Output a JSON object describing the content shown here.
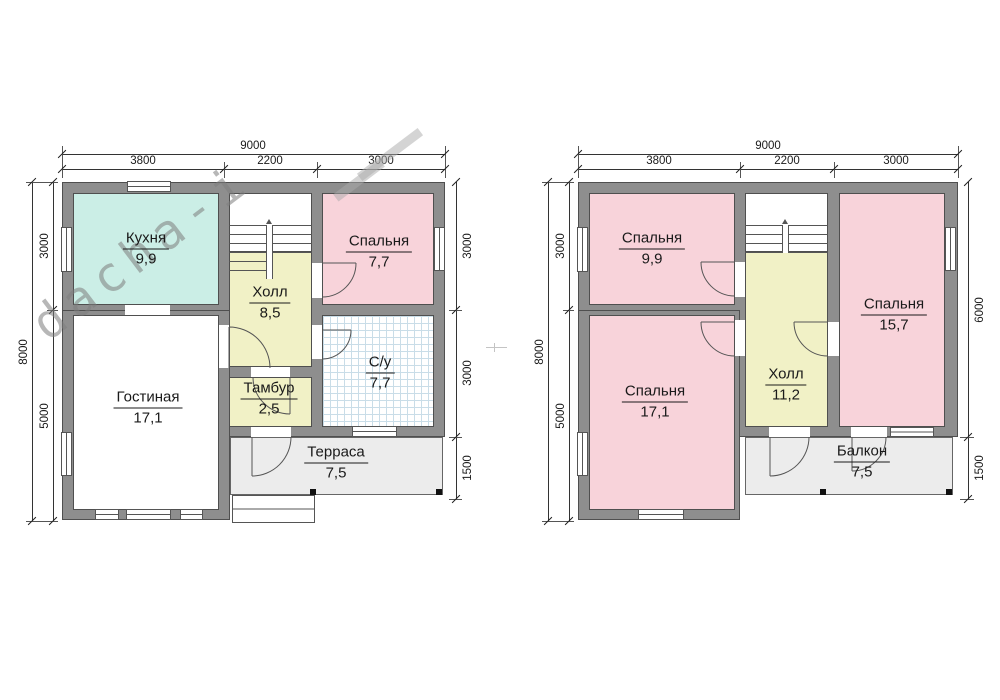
{
  "watermark": {
    "text": "dacha-i"
  },
  "plans": [
    {
      "name": "first-floor",
      "dims": {
        "top_total": "9000",
        "top_segments": [
          "3800",
          "2200",
          "3000"
        ],
        "side_total": "8000",
        "side_segments": [
          "3000",
          "5000"
        ],
        "right_segments": [
          "3000",
          "3000",
          "1500"
        ]
      },
      "rooms": [
        {
          "name": "Кухня",
          "area": "9,9"
        },
        {
          "name": "Холл",
          "area": "8,5"
        },
        {
          "name": "Спальня",
          "area": "7,7"
        },
        {
          "name": "С/у",
          "area": "7,7"
        },
        {
          "name": "Тамбур",
          "area": "2,5"
        },
        {
          "name": "Гостиная",
          "area": "17,1"
        },
        {
          "name": "Терраса",
          "area": "7,5"
        }
      ]
    },
    {
      "name": "second-floor",
      "dims": {
        "top_total": "9000",
        "top_segments": [
          "3800",
          "2200",
          "3000"
        ],
        "side_total": "8000",
        "side_segments": [
          "3000",
          "5000"
        ],
        "right_segments": [
          "6000",
          "1500"
        ]
      },
      "rooms": [
        {
          "name": "Спальня",
          "area": "9,9"
        },
        {
          "name": "Спальня",
          "area": "15,7"
        },
        {
          "name": "Спальня",
          "area": "17,1"
        },
        {
          "name": "Холл",
          "area": "11,2"
        },
        {
          "name": "Балкон",
          "area": "7,5"
        }
      ]
    }
  ],
  "colors": {
    "wall": "#8e8e8e",
    "bedroom_pink": "#f8d3da",
    "kitchen_teal": "#cbeee6",
    "hall_yellow": "#f1f1c6",
    "deck_grey": "#ececec",
    "tile_line": "#c9dde8",
    "line": "#333333"
  }
}
